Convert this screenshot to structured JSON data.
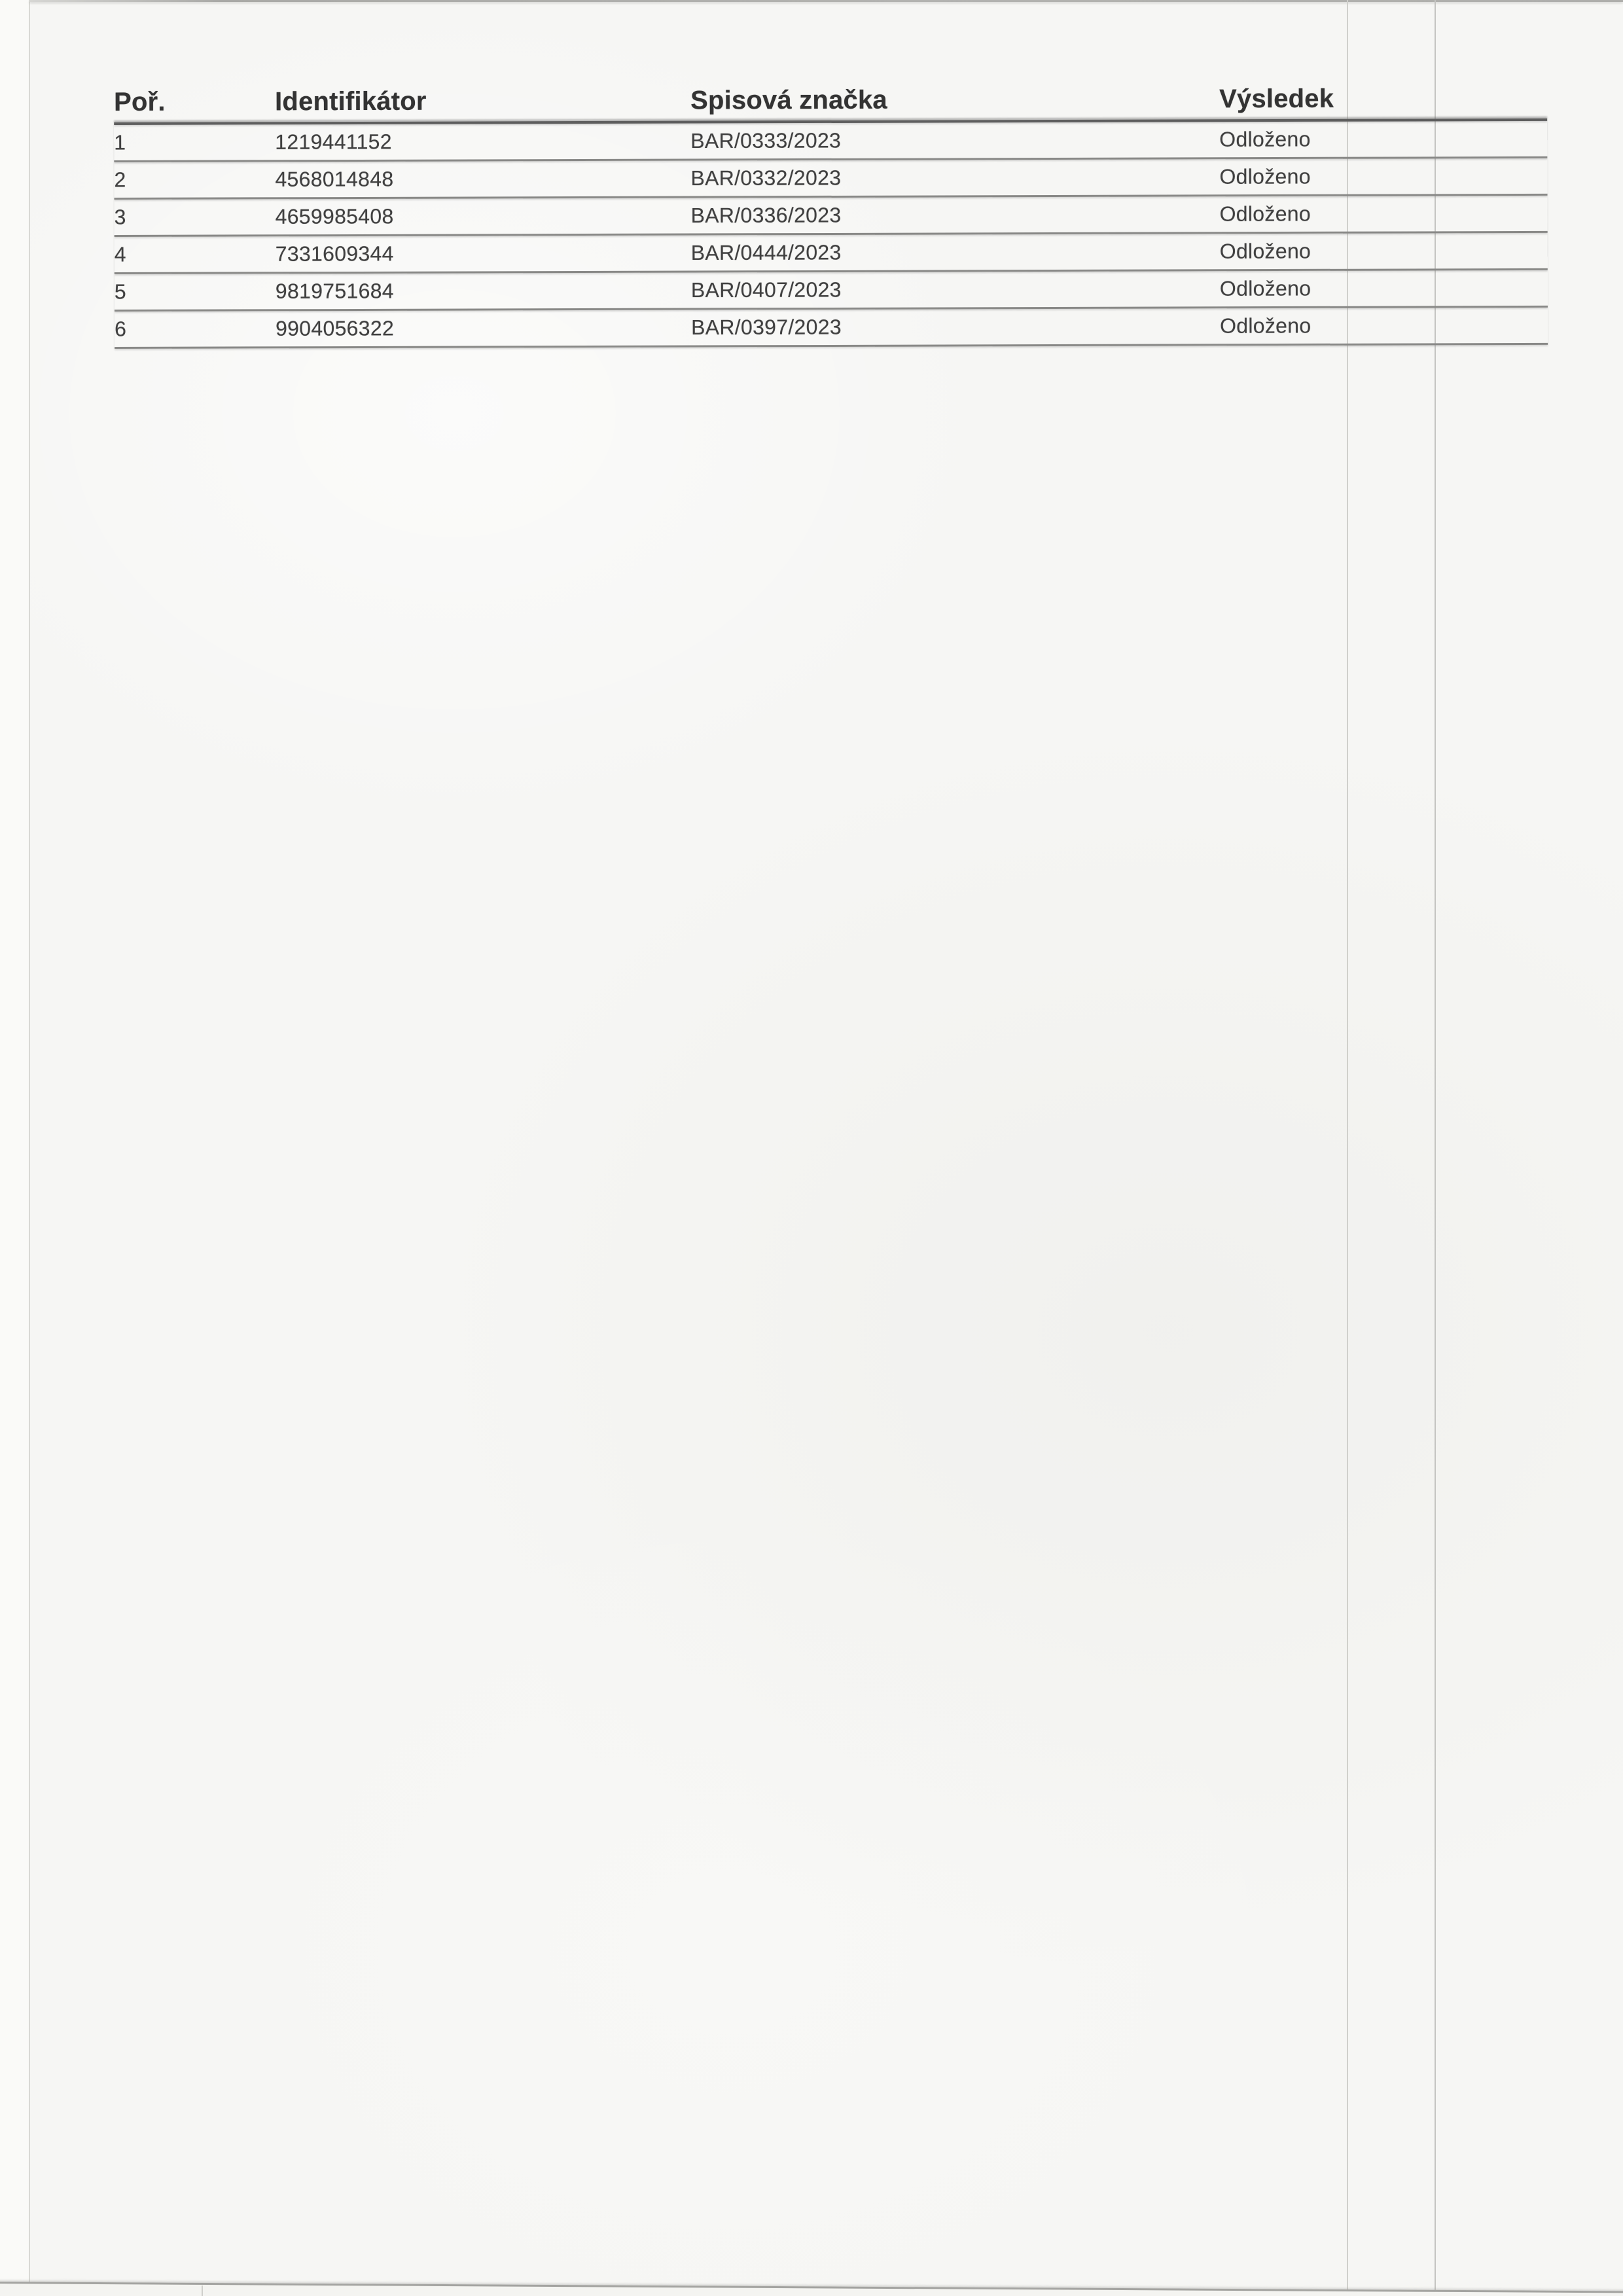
{
  "table": {
    "columns": [
      "Poř.",
      "Identifikátor",
      "Spisová značka",
      "Výsledek"
    ],
    "rows": [
      {
        "poradi": "1",
        "identifikator": "1219441152",
        "spisova_znacka": "BAR/0333/2023",
        "vysledek": "Odloženo"
      },
      {
        "poradi": "2",
        "identifikator": "4568014848",
        "spisova_znacka": "BAR/0332/2023",
        "vysledek": "Odloženo"
      },
      {
        "poradi": "3",
        "identifikator": "4659985408",
        "spisova_znacka": "BAR/0336/2023",
        "vysledek": "Odloženo"
      },
      {
        "poradi": "4",
        "identifikator": "7331609344",
        "spisova_znacka": "BAR/0444/2023",
        "vysledek": "Odloženo"
      },
      {
        "poradi": "5",
        "identifikator": "9819751684",
        "spisova_znacka": "BAR/0407/2023",
        "vysledek": "Odloženo"
      },
      {
        "poradi": "6",
        "identifikator": "9904056322",
        "spisova_znacka": "BAR/0397/2023",
        "vysledek": "Odloženo"
      }
    ]
  },
  "colors": {
    "paper": "#f6f6f4",
    "header_ink": "#333333",
    "body_ink": "#404040",
    "header_rule": "#5e5e5e",
    "row_rule": "#898987",
    "crease": "#c9c9c6",
    "page_edge": "#a4a4a1"
  }
}
